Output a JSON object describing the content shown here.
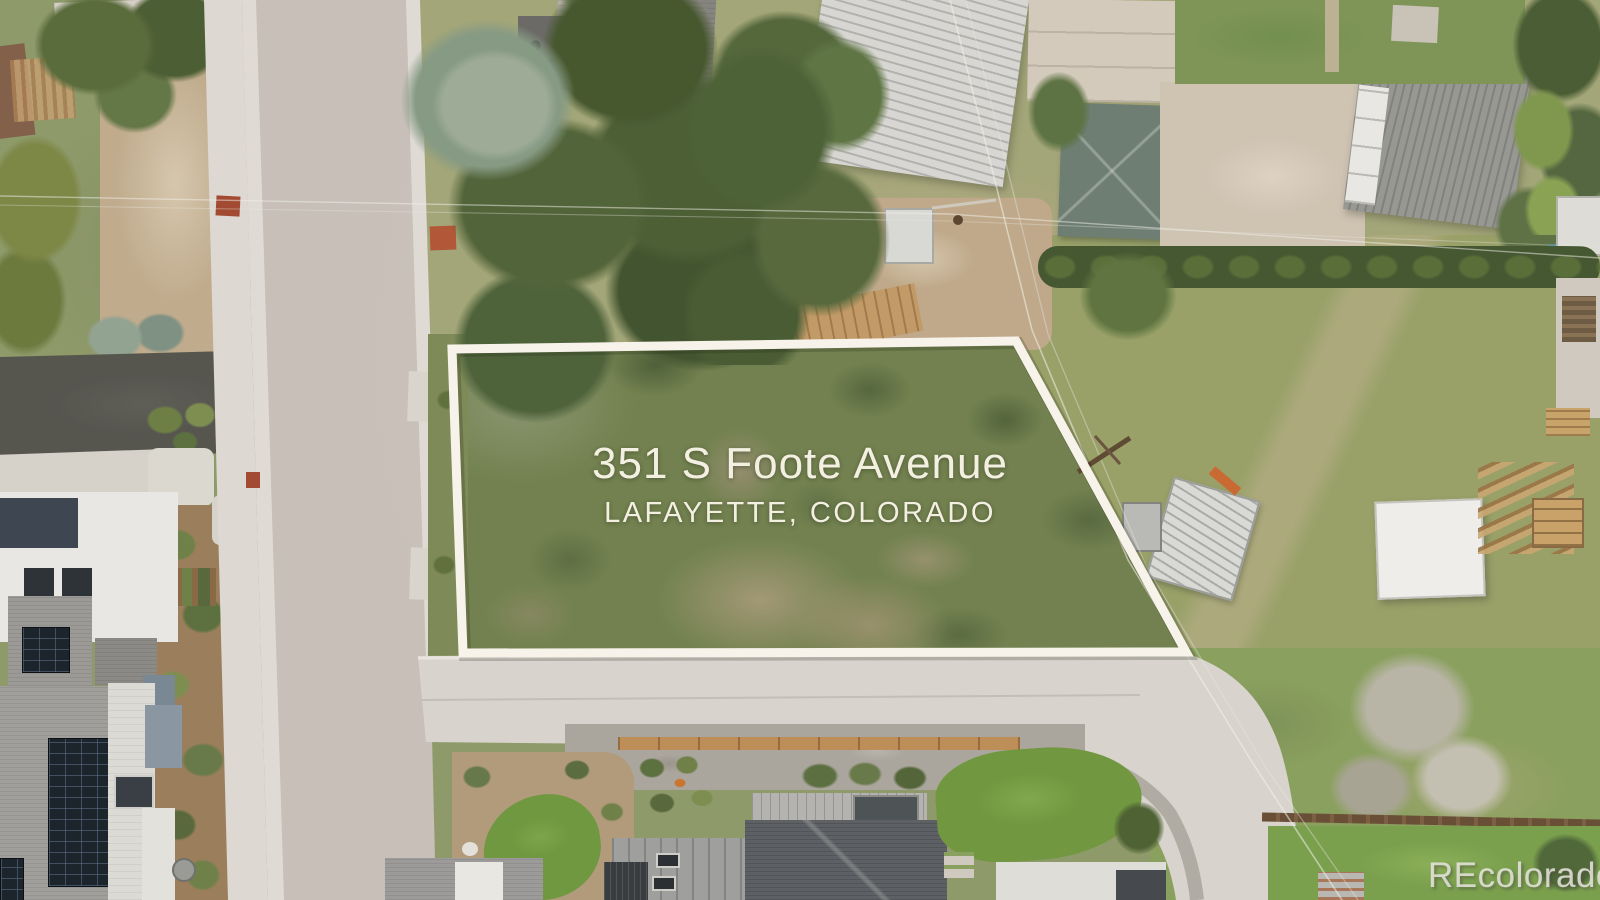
{
  "photo": {
    "type": "aerial-drone-listing-photo",
    "address": "351 S Foote Avenue",
    "location": "LAFAYETTE, COLORADO"
  },
  "watermark": {
    "text": "REcolorado"
  },
  "annotation": {
    "boundary_color": "#f7f3ea",
    "text_color": "#f3f0e2"
  },
  "palette": {
    "lot_grass": "#72814f",
    "dry_yard": "#99a169",
    "dirt_tan": "#c0ab8c",
    "asphalt_street": "#c7bfb8",
    "concrete_street": "#d8d4cd",
    "sidewalk": "#ddd8d1",
    "tree_dark": "#47582f",
    "spruce_silver": "#869a84",
    "roof_charcoal": "#54575b",
    "roof_gray_shingle": "#9c9b97",
    "roof_white_metal": "#d7d6d2",
    "roof_teal": "#6e7e73",
    "solar_panel": "#1c242c",
    "wood_fence": "#bd8e58"
  }
}
